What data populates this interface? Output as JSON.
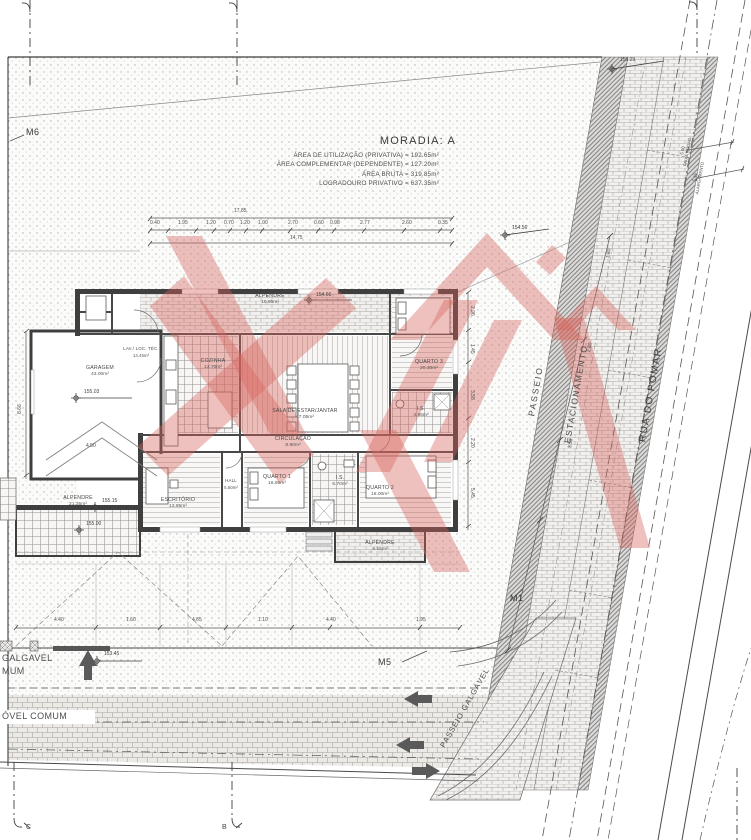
{
  "title_block": {
    "title": "MORADIA: A",
    "area_lines": [
      "ÁREA DE UTILIZAÇÃO (PRIVATIVA) = 192.65m²",
      "ÁREA COMPLEMENTAR (DEPENDENTE) = 127.20m²",
      "ÁREA BRUTA  = 319.85m²",
      "LOGRADOURO PRIVATIVO = 637.35m²"
    ]
  },
  "streets": {
    "road_name": "RUA DO POMAR",
    "sidewalk": "PASSEIO",
    "parking": "ESTACIONAMENTO",
    "sidewalk_walkable": "PASSEIO GALGÁVEL"
  },
  "road_dimensions": [
    {
      "value": "5.00",
      "label": "FAIXA RODAG."
    },
    {
      "value": "5.45",
      "label": "ALARGAMENTO"
    }
  ],
  "wall_markers": {
    "m1": "M1",
    "m5": "M5",
    "m6": "M6"
  },
  "section_markers": {
    "bottom_left": "C",
    "bottom_mid": "B"
  },
  "boundary_fragments": {
    "line1": "GALGAVEL",
    "line2": "MUM",
    "line3": "ÓVEL COMUM"
  },
  "rooms": {
    "alpendre_n": {
      "name": "ALPENDRE",
      "area": "10.95m²"
    },
    "garagem": {
      "name": "GARAGEM",
      "area": "43.00m²"
    },
    "lav": {
      "name": "LAV./ LOC. TÉC.",
      "area": "14.45m²"
    },
    "cozinha": {
      "name": "COZINHA",
      "area": "13.70m²"
    },
    "sala": {
      "name": "SALA DE ESTAR/JANTAR",
      "area": "47.05m²"
    },
    "quarto3": {
      "name": "QUARTO 3",
      "area": "20.30m²"
    },
    "is_norte": {
      "name": "I.S.",
      "area": "4.85m²"
    },
    "circulacao": {
      "name": "CIRCULAÇÃO",
      "area": "8.90m²"
    },
    "hall": {
      "name": "HALL",
      "area": "5.60m²"
    },
    "escritorio": {
      "name": "ESCRITÓRIO",
      "area": "13.85m²"
    },
    "quarto1": {
      "name": "QUARTO 1",
      "area": "16.95m²"
    },
    "is_sul": {
      "name": "I.S.",
      "area": "6.70m²"
    },
    "quarto2": {
      "name": "QUARTO 2",
      "area": "16.00m²"
    },
    "alpendre_s": {
      "name": "ALPENDRE",
      "area": "8.15m²"
    },
    "alpendre_sw": {
      "name": "ALPENDRE",
      "area": "21.35m²"
    }
  },
  "levels": {
    "street_top": "155.29",
    "lot_ne": "154.56",
    "porch_n": "154.66",
    "garage": "155.03",
    "porch_sw": "155.15",
    "porch_sw2": "155.00",
    "lot_s": "153.45"
  },
  "dimensions": {
    "top_overall": "17.85",
    "top_total": "14.75",
    "items": [
      {
        "t": "17.85",
        "x": 234,
        "y": 209,
        "r": 0
      },
      {
        "t": "0.40",
        "x": 150,
        "y": 221,
        "r": 0
      },
      {
        "t": "1.95",
        "x": 178,
        "y": 221,
        "r": 0
      },
      {
        "t": "1.20",
        "x": 206,
        "y": 221,
        "r": 0
      },
      {
        "t": "0.70",
        "x": 224,
        "y": 221,
        "r": 0
      },
      {
        "t": "1.20",
        "x": 240,
        "y": 221,
        "r": 0
      },
      {
        "t": "1.00",
        "x": 258,
        "y": 221,
        "r": 0
      },
      {
        "t": "2.70",
        "x": 288,
        "y": 221,
        "r": 0
      },
      {
        "t": "0.60",
        "x": 314,
        "y": 221,
        "r": 0
      },
      {
        "t": "0.98",
        "x": 330,
        "y": 221,
        "r": 0
      },
      {
        "t": "2.77",
        "x": 360,
        "y": 221,
        "r": 0
      },
      {
        "t": "2.60",
        "x": 402,
        "y": 221,
        "r": 0
      },
      {
        "t": "0.35",
        "x": 438,
        "y": 221,
        "r": 0
      },
      {
        "t": "14.75",
        "x": 290,
        "y": 236,
        "r": 0
      },
      {
        "t": "2.96",
        "x": 474,
        "y": 306,
        "r": 90
      },
      {
        "t": "1.45",
        "x": 474,
        "y": 344,
        "r": 90
      },
      {
        "t": "3.58",
        "x": 474,
        "y": 390,
        "r": 90
      },
      {
        "t": "2.20",
        "x": 474,
        "y": 438,
        "r": 90
      },
      {
        "t": "5.45",
        "x": 474,
        "y": 488,
        "r": 90
      },
      {
        "t": "8.66",
        "x": 18,
        "y": 414,
        "r": -90
      },
      {
        "t": "4.50",
        "x": 86,
        "y": 444,
        "r": 0
      },
      {
        "t": "4.40",
        "x": 54,
        "y": 618,
        "r": 0
      },
      {
        "t": "1.60",
        "x": 126,
        "y": 618,
        "r": 0
      },
      {
        "t": "4.65",
        "x": 192,
        "y": 618,
        "r": 0
      },
      {
        "t": "1.10",
        "x": 258,
        "y": 618,
        "r": 0
      },
      {
        "t": "4.40",
        "x": 326,
        "y": 618,
        "r": 0
      },
      {
        "t": "1.95",
        "x": 416,
        "y": 618,
        "r": 0
      },
      {
        "t": "1.80",
        "x": 606,
        "y": 258,
        "r": -80
      },
      {
        "t": "2.80",
        "x": 587,
        "y": 352,
        "r": -80
      },
      {
        "t": "3.50",
        "x": 568,
        "y": 448,
        "r": -80
      }
    ]
  },
  "watermark_color": "#d7645c"
}
